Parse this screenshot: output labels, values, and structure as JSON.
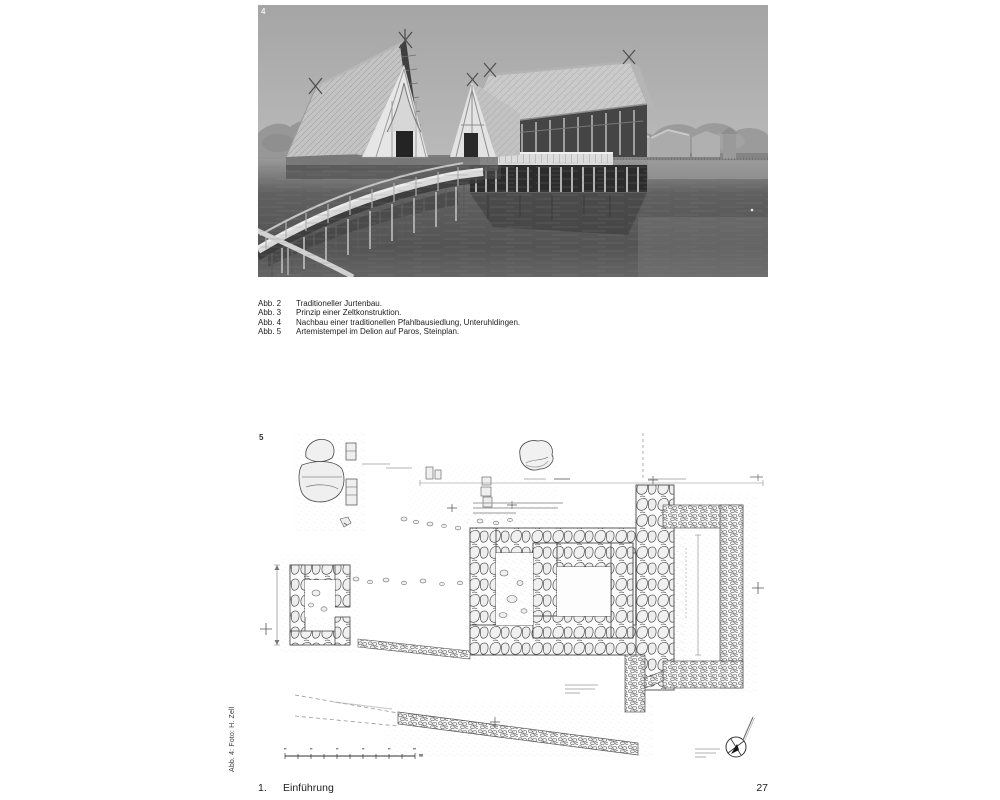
{
  "page": {
    "background": "#ffffff"
  },
  "figure_photo": {
    "number": "4"
  },
  "figure_plan": {
    "number": "5"
  },
  "captions": {
    "items": [
      {
        "label": "Abb. 2",
        "text": "Traditioneller Jurtenbau."
      },
      {
        "label": "Abb. 3",
        "text": "Prinzip einer Zeltkonstruktion."
      },
      {
        "label": "Abb. 4",
        "text": "Nachbau einer traditionellen Pfahlbausiedlung, Unteruhldingen."
      },
      {
        "label": "Abb. 5",
        "text": "Artemistempel im Delion auf Paros, Steinplan."
      }
    ]
  },
  "sidebar": {
    "credit": "Abb. 4: Foto: H. Zell"
  },
  "footer": {
    "chapter_number": "1.",
    "chapter_title": "Einführung",
    "page_number": "27"
  },
  "colors": {
    "text": "#1d1d1d",
    "photo_label": "#ededed",
    "plan_label": "#2f2f2f"
  }
}
